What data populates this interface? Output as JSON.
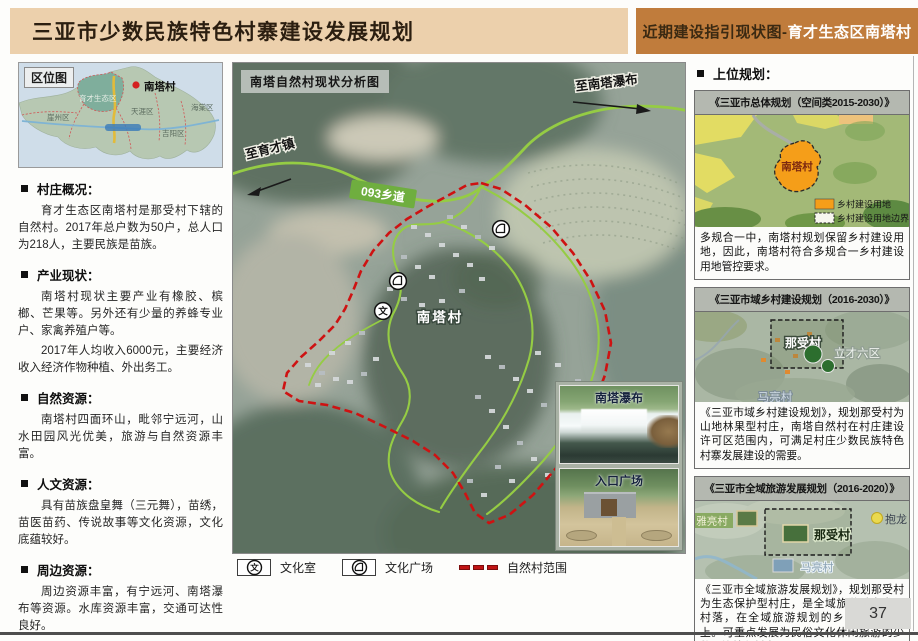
{
  "header": {
    "title": "三亚市少数民族特色村寨建设发展规划",
    "tab_prefix": "近期建设指引现状图-",
    "tab_suffix": "育才生态区南塔村"
  },
  "left": {
    "loc_title": "区位图",
    "loc_map": {
      "marker": "南塔村",
      "regions": [
        "育才生态区",
        "崖州区",
        "天涯区",
        "吉阳区",
        "海棠区"
      ]
    },
    "sections": [
      {
        "title": "村庄概况：",
        "paras": [
          "育才生态区南塔村是那受村下辖的自然村。2017年总户数为50户，总人口为218人，主要民族是苗族。"
        ]
      },
      {
        "title": "产业现状：",
        "paras": [
          "南塔村现状主要产业有橡胶、槟榔、芒果等。另外还有少量的养蜂专业户、家禽养殖户等。",
          "2017年人均收入6000元，主要经济收入经济作物种植、外出务工。"
        ]
      },
      {
        "title": "自然资源：",
        "paras": [
          "南塔村四面环山，毗邻宁远河，山水田园风光优美，旅游与自然资源丰富。"
        ]
      },
      {
        "title": "人文资源：",
        "paras": [
          "具有苗族盘皇舞（三元舞），苗绣，苗医苗药、传说故事等文化资源，文化底蕴较好。"
        ]
      },
      {
        "title": "周边资源：",
        "paras": [
          "周边资源丰富，有宁远河、南塔瀑布等资源。水库资源丰富，交通可达性良好。"
        ]
      }
    ]
  },
  "map": {
    "title": "南塔自然村现状分析图",
    "to_yucai": "至育才镇",
    "road_badge": "093乡道",
    "to_waterfall": "至南塔瀑布",
    "village": "南塔村",
    "icon_wen": "文",
    "photos": [
      {
        "label": "南塔瀑布"
      },
      {
        "label": "入口广场"
      }
    ],
    "legend": [
      {
        "label": "文化室"
      },
      {
        "label": "文化广场"
      },
      {
        "label": "自然村范围"
      }
    ]
  },
  "right": {
    "heading": "上位规划：",
    "panels": [
      {
        "title": "《三亚市总体规划（空间类2015-2030）》",
        "village": "南塔村",
        "legend": [
          "乡村建设用地",
          "乡村建设用地边界"
        ],
        "text": "多规合一中，南塔村规划保留乡村建设用地，因此，南塔村符合多规合一乡村建设用地管控要求。"
      },
      {
        "title": "《三亚市域乡村建设规划（2016-2030）》",
        "labels": {
          "focus": "那受村",
          "district": "立才六区",
          "village2": "马亮村"
        },
        "text": "《三亚市域乡村建设规划》，规划那受村为山地林果型村庄，南塔自然村在村庄建设许可区范围内，可满足村庄少数民族特色村寨发展建设的需要。"
      },
      {
        "title": "《三亚市全域旅游发展规划（2016-2020）》",
        "labels": {
          "focus": "那受村",
          "left": "雅亮村",
          "right": "抱龙",
          "below": "马亮村"
        },
        "text": "《三亚市全域旅游发展规划》，规划那受村为生态保护型村庄，是全域旅游重点发展村落，在全域旅游规划的乡村旅游路线上。可重点发展为民俗文化休闲旅游的少数民族特色村寨。"
      }
    ]
  },
  "footer": {
    "page": "37"
  },
  "colors": {
    "header_bg": "#ecd0ac",
    "tab_bg": "#c07c3c",
    "road_green": "#95cc44",
    "boundary_red": "#ce1212",
    "landuse_orange": "#f59e19"
  }
}
